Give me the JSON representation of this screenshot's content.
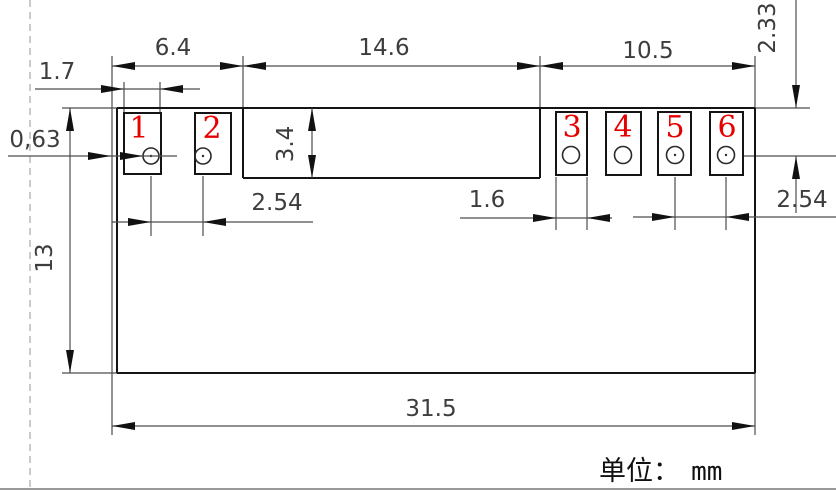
{
  "drawing": {
    "title": "module-dimension-drawing",
    "unit": {
      "prefix": "单位：",
      "value": "mm"
    },
    "dims": {
      "top_left": "6.4",
      "top_middle": "14.6",
      "top_right": "10.5",
      "pad_width_left": "1.7",
      "hole_offset": "0,63",
      "block_height": "3.4",
      "edge_to_hole_center": "2.33",
      "pitch_left": "2.54",
      "pad_width_right": "1.6",
      "pitch_right": "2.54",
      "body_height": "13",
      "body_width": "31.5"
    },
    "pads": [
      {
        "label": "1"
      },
      {
        "label": "2"
      },
      {
        "label": "3"
      },
      {
        "label": "4"
      },
      {
        "label": "5"
      },
      {
        "label": "6"
      }
    ],
    "colors": {
      "outline": "#141414",
      "dimension_line": "#4d4d4d",
      "pad_number": "#e60000",
      "guide_dashed": "#b4b4b4",
      "background": "#ffffff"
    }
  }
}
